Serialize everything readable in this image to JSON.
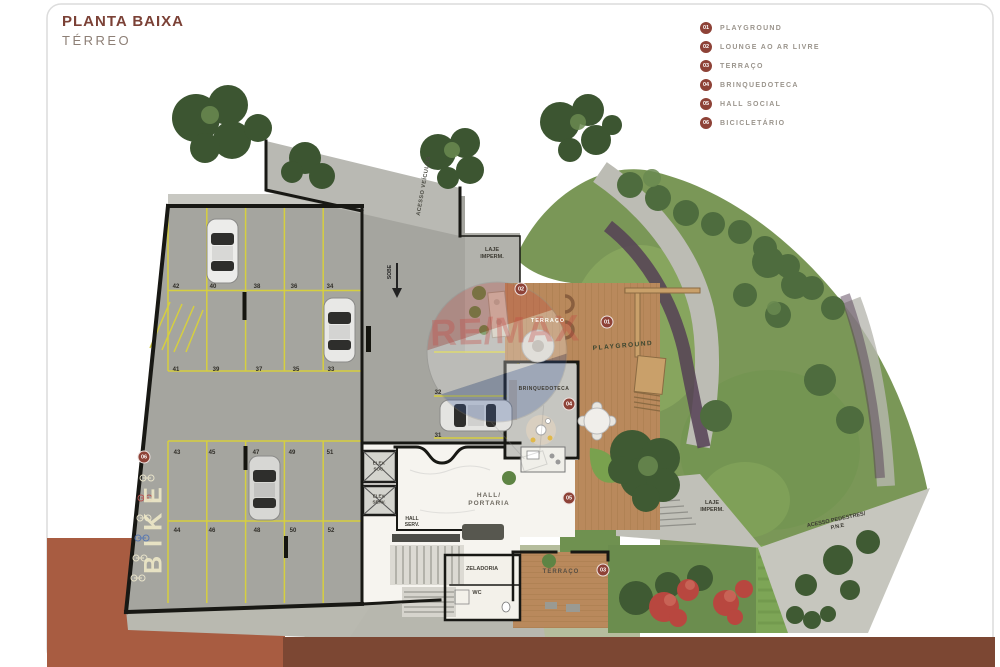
{
  "header": {
    "title": "PLANTA BAIXA",
    "subtitle": "TÉRREO"
  },
  "legend": {
    "items": [
      {
        "num": "01",
        "label": "PLAYGROUND"
      },
      {
        "num": "02",
        "label": "LOUNGE AO AR LIVRE"
      },
      {
        "num": "03",
        "label": "TERRAÇO"
      },
      {
        "num": "04",
        "label": "BRINQUEDOTECA"
      },
      {
        "num": "05",
        "label": "HALL SOCIAL"
      },
      {
        "num": "06",
        "label": "BICICLETÁRIO"
      }
    ]
  },
  "plan": {
    "labels": {
      "acesso_veiculos": "ACESSO VEÍCULOS",
      "sobe": "SOBE",
      "laje_line1": "LAJE",
      "laje_line2": "IMPERM.",
      "hall_line1": "HALL/",
      "hall_line2": "PORTARIA",
      "hall_serv_line1": "HALL",
      "hall_serv_line2": "SERV.",
      "elev_line1": "ELEV.",
      "elev_soc_line2": "SOC.",
      "elev_serv_line2": "SERV.",
      "zeladoria": "ZELADORIA",
      "wc": "WC",
      "terraco_lounge": "TERRAÇO",
      "terraco_deck": "TERRAÇO",
      "playground": "PLAYGROUND",
      "brinquedoteca": "BRINQUEDOTECA",
      "acesso_pedestres_line1": "ACESSO PEDESTRES/",
      "acesso_pedestres_line2": "P.N.E",
      "bike": "BIKE"
    },
    "parking": {
      "row_a": [
        "42",
        "40",
        "38",
        "36",
        "34"
      ],
      "row_b": [
        "41",
        "39",
        "37",
        "35",
        "33"
      ],
      "row_c": [
        "43",
        "45",
        "47",
        "49",
        "51"
      ],
      "row_d": [
        "44",
        "46",
        "48",
        "50",
        "52"
      ],
      "row_e": [
        "32",
        "31"
      ]
    }
  },
  "watermark": {
    "text": "RE/MAX"
  },
  "colors": {
    "accent": "#8E4237",
    "title": "#7B4136",
    "legend_text": "#9B958D",
    "wood": "#B9895C",
    "grass": "#7A9757",
    "concrete": "#A5A59F",
    "street": "#7C4733",
    "terracotta": "#A85C41",
    "stall_line": "#D6CF3F"
  }
}
